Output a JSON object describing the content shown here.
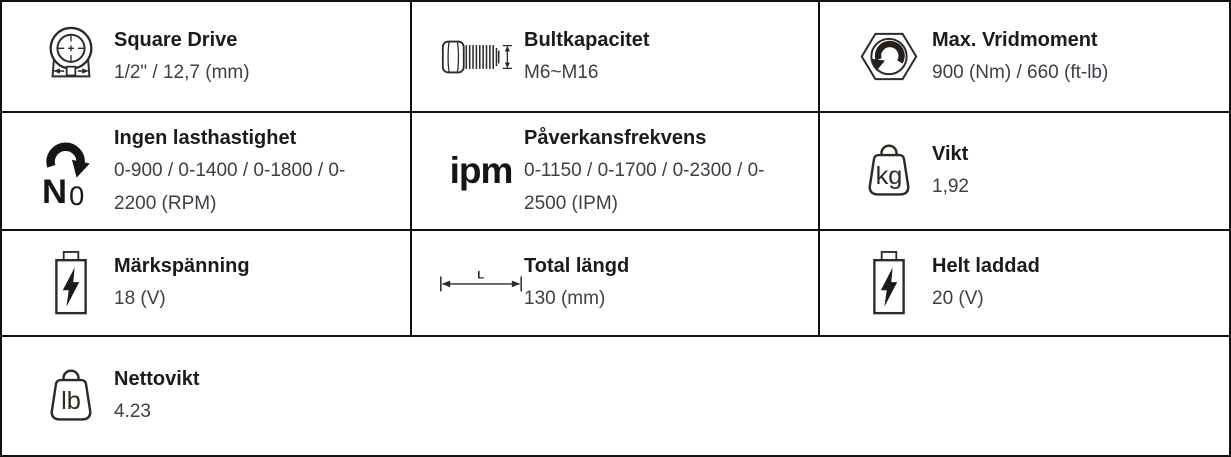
{
  "colors": {
    "border": "#111111",
    "title_text": "#1b1b1e",
    "value_text": "#3e3e46",
    "icon": "#2b2b2b"
  },
  "icon_glyphs": {
    "no_load_letter": "N",
    "no_load_subscript": "0",
    "ipm": "ipm",
    "kg": "kg",
    "lb": "lb",
    "length": "L"
  },
  "cells": [
    {
      "icon": "square-drive-icon",
      "title": "Square Drive",
      "value": "1/2\" / 12,7 (mm)"
    },
    {
      "icon": "bolt-capacity-icon",
      "title": "Bultkapacitet",
      "value": "M6~M16"
    },
    {
      "icon": "max-torque-icon",
      "title": "Max. Vridmoment",
      "value": "900 (Nm) / 660 (ft-lb)"
    },
    {
      "icon": "no-load-speed-icon",
      "title": "Ingen lasthastighet",
      "value": "0-900 / 0-1400 / 0-1800 / 0-2200 (RPM)"
    },
    {
      "icon": "impact-rate-icon",
      "title": "Påverkansfrekvens",
      "value": "0-1150 / 0-1700 / 0-2300 / 0-2500 (IPM)"
    },
    {
      "icon": "weight-kg-icon",
      "title": "Vikt",
      "value": "1,92"
    },
    {
      "icon": "battery-voltage-icon",
      "title": "Märkspänning",
      "value": "18 (V)"
    },
    {
      "icon": "overall-length-icon",
      "title": "Total längd",
      "value": "130 (mm)"
    },
    {
      "icon": "battery-voltage-icon",
      "title": "Helt laddad",
      "value": "20 (V)"
    },
    {
      "icon": "weight-lb-icon",
      "title": "Nettovikt",
      "value": "4.23"
    }
  ]
}
